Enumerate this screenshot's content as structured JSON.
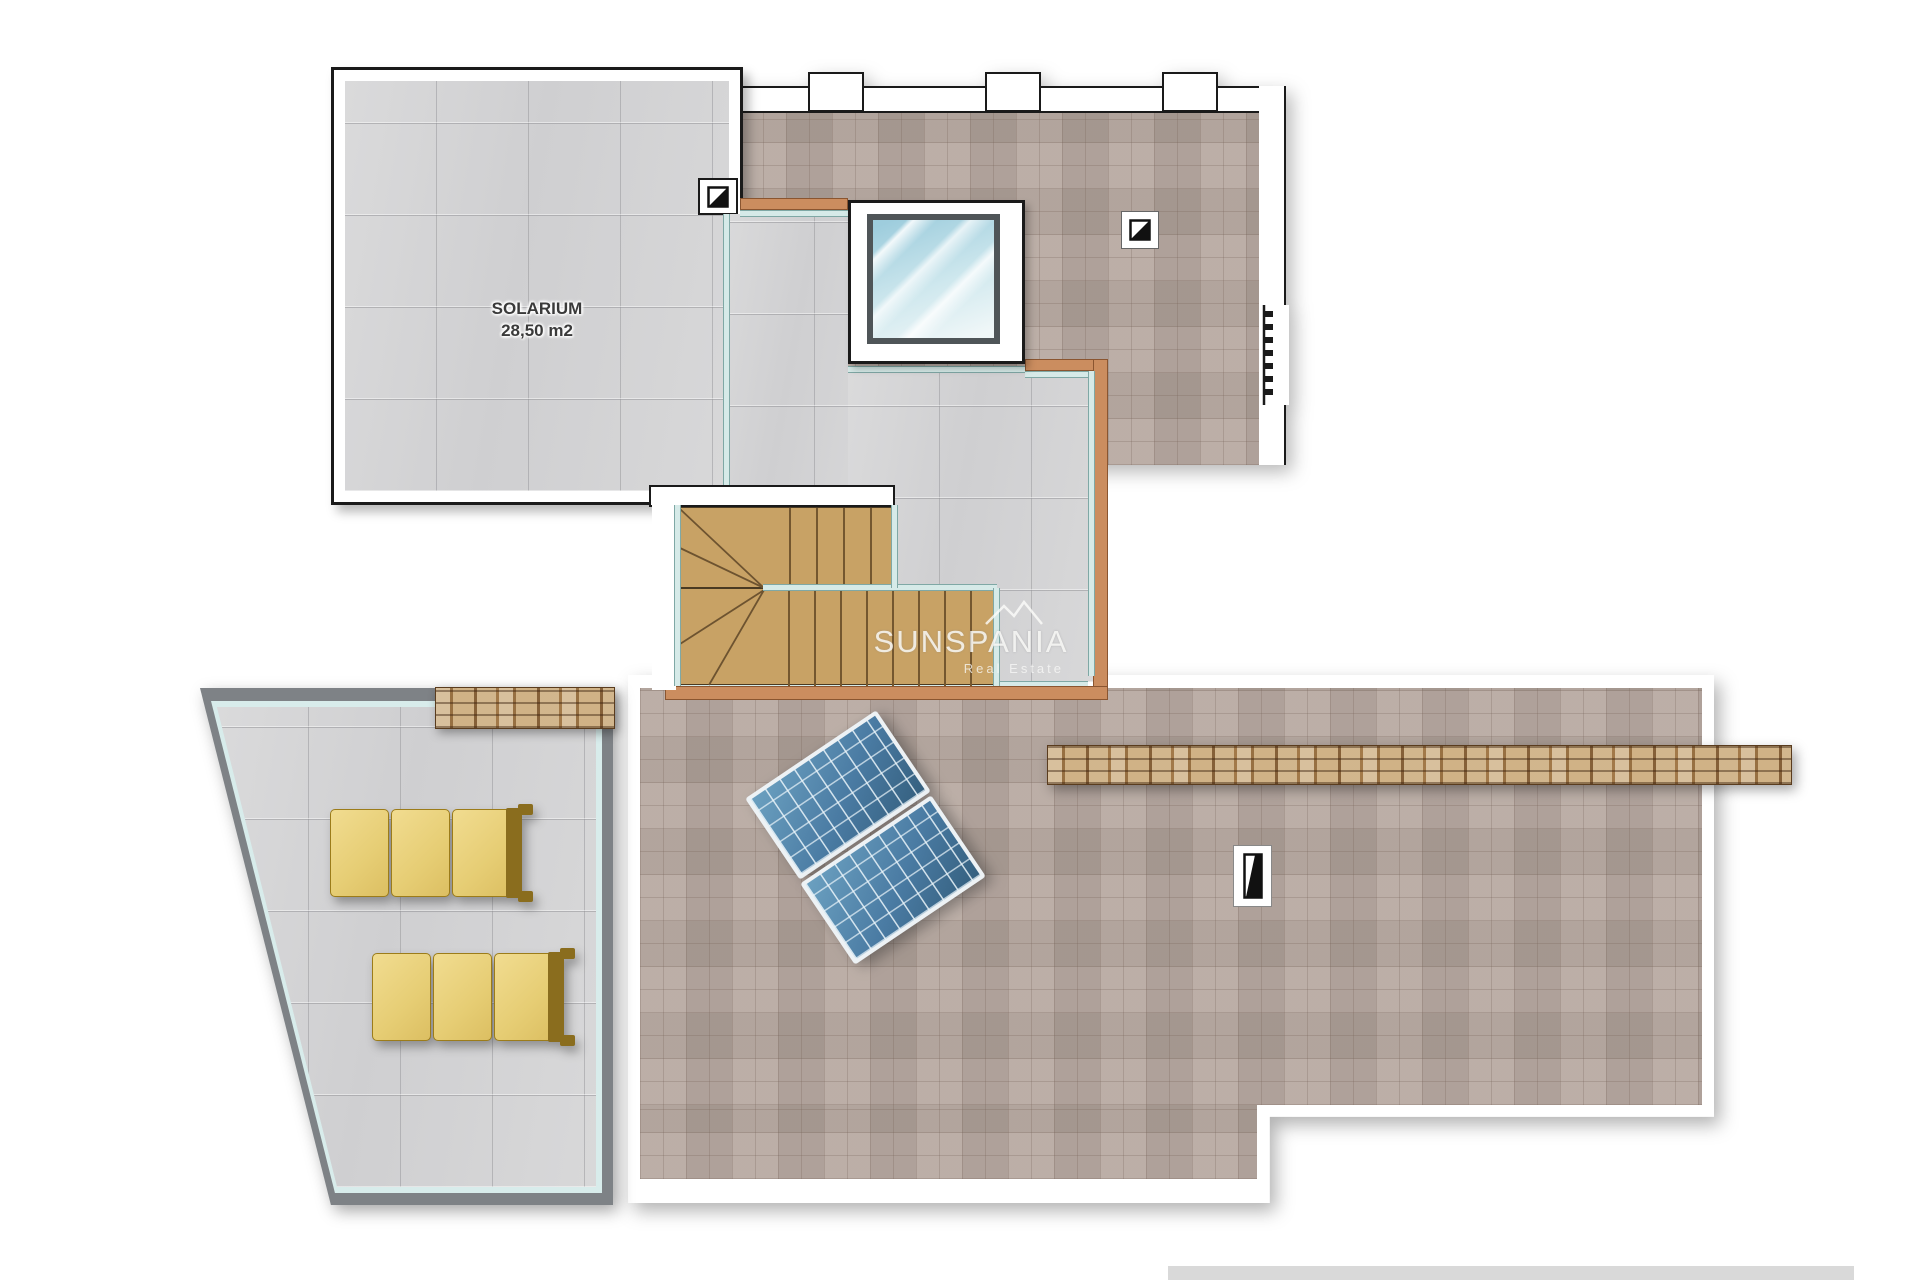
{
  "plan": {
    "title": "Villa roof / solarium floor plan",
    "solarium": {
      "label": "SOLARIUM",
      "area": "28,50 m2"
    },
    "watermark": {
      "brand": "SUNSPANIA",
      "tagline": "Real Estate"
    },
    "colors": {
      "tile_gray": "#d5d5d6",
      "paving_brown": "#b4a59d",
      "wood_stairs": "#c8a265",
      "glass_railing_teal": "#d6eae8",
      "band_terracotta": "#cb8d5f",
      "solar_panel_blue": "#4a7ba3",
      "lounger_yellow": "#e6cd74",
      "stone_wall_tan": "#b08a58",
      "terrace_border_gray": "#7e8286",
      "bottom_bar_gray": "#d9d9d9"
    },
    "icons": [
      "drain-icon",
      "drain-icon",
      "chimney-icon",
      "roof-ladder-icon",
      "mountain-logo-icon"
    ]
  }
}
